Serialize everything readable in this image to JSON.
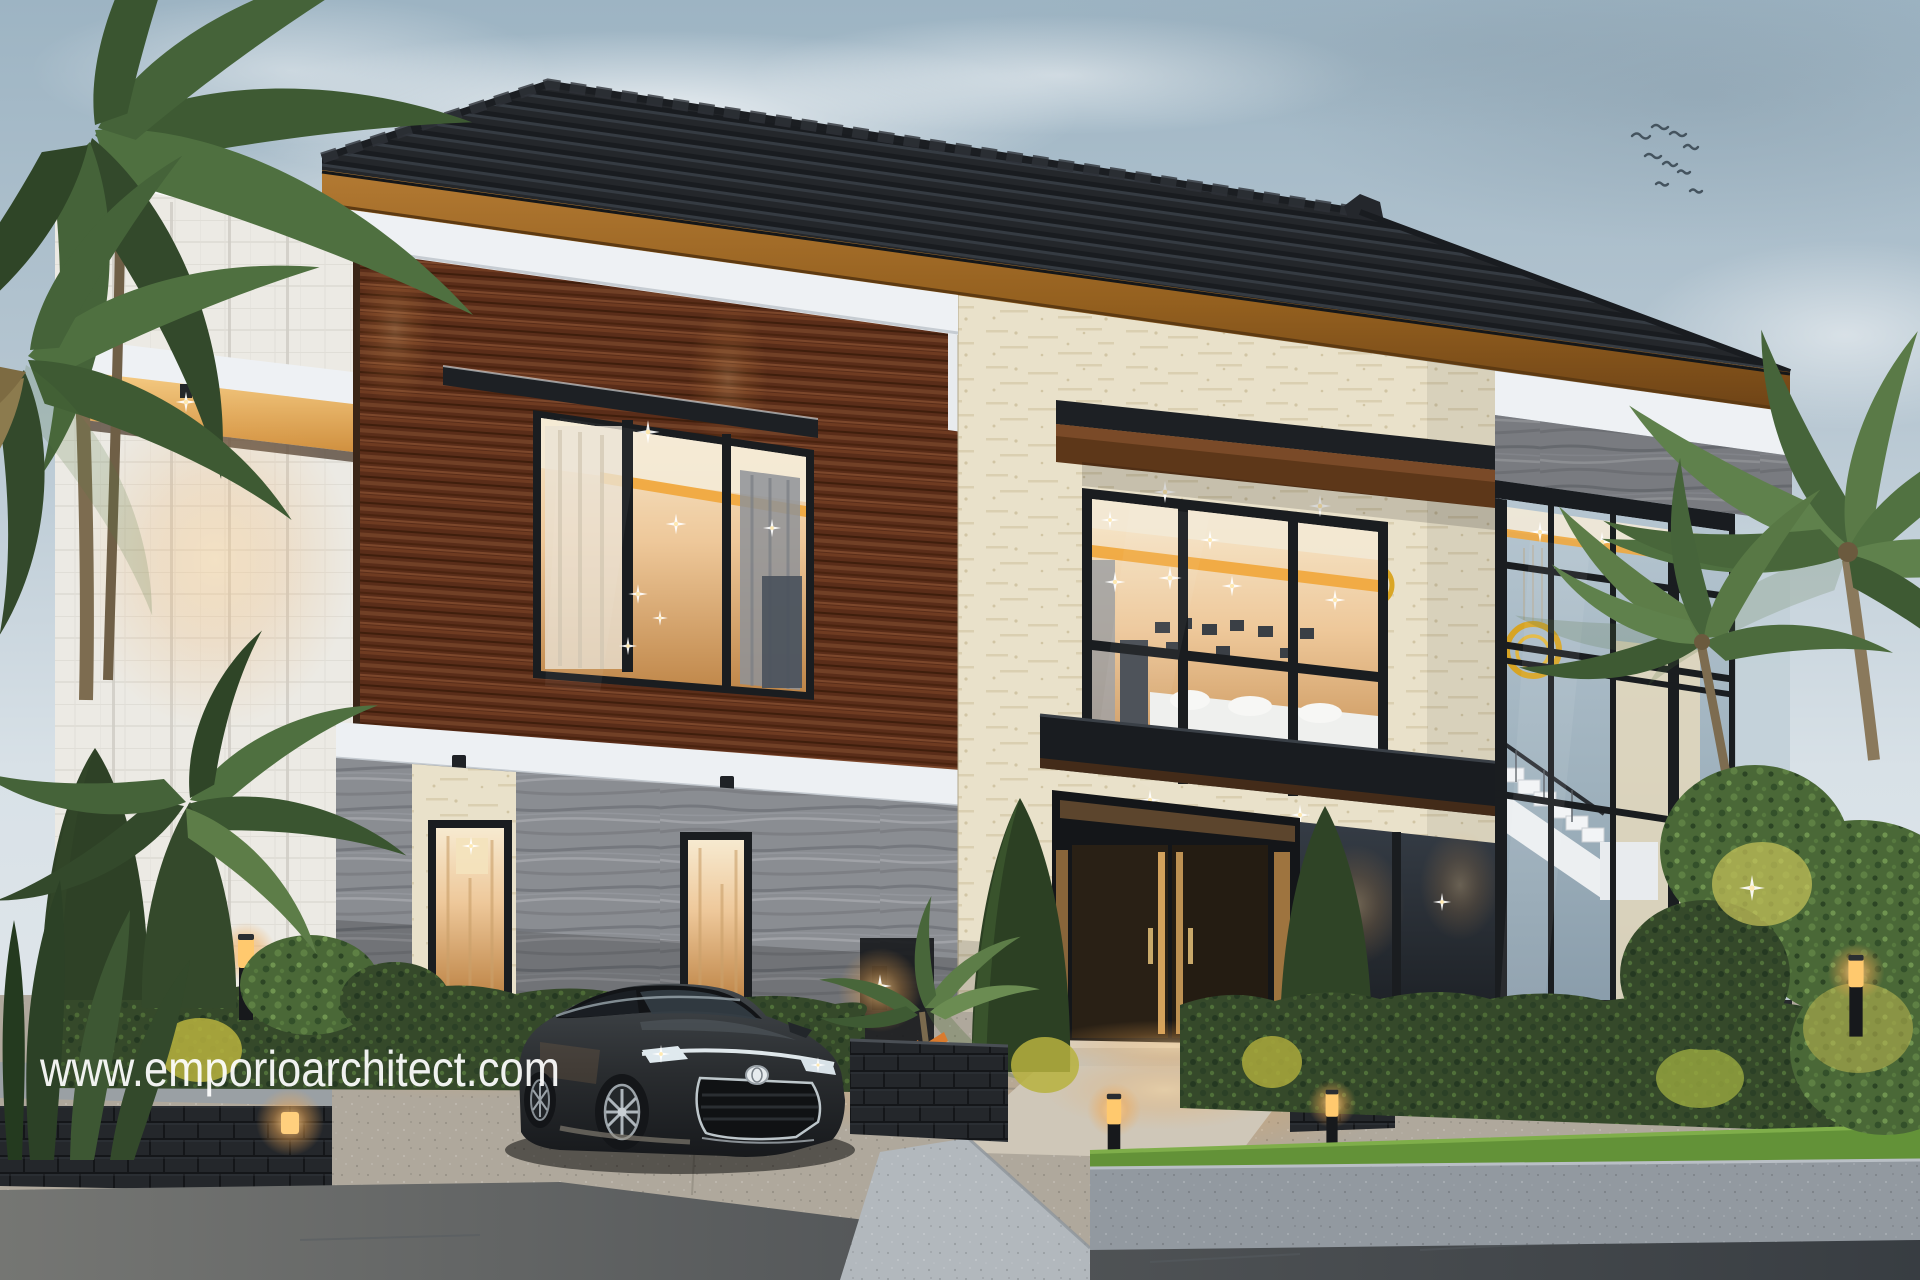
{
  "watermark": {
    "text": "www.emporioarchitect.com",
    "color": "#ffffff"
  },
  "scene": {
    "description": "Dusk 3D exterior rendering of a modern two-storey tropical house: dark ribbed hip roof with timber fascia, walnut wood and cream travertine facades, grey streaked-stone ground floor, black-framed warm-lit windows, glass stair atrium with gold ring chandeliers, manicured hedges, bollard lights, palm trees, and a black Toyota sedan parked on the driveway.",
    "time_of_day": "dusk",
    "objects": [
      "sky",
      "clouds",
      "bird-flock",
      "main-roof",
      "roof-fascia",
      "left-tile-wall",
      "lit-side-canopy",
      "wood-facade",
      "bedroom-window",
      "window-eyebrow-canopy",
      "floor-divider-band",
      "downlights",
      "stone-ground-floor",
      "tall-window-1",
      "tall-window-2",
      "wall-sconce",
      "travertine-facade",
      "living-room-window-box",
      "entrance-canopy",
      "balcony-slab",
      "entrance-doors",
      "door-sidelights",
      "first-floor-glass",
      "stair-atrium-glass",
      "staircase",
      "ring-chandeliers",
      "stone-cap-band",
      "white-fascia-bands",
      "left-palm-cluster",
      "right-palm-cluster",
      "foreground-plants",
      "front-hedge",
      "cone-trees",
      "planters",
      "bollard-lights",
      "lit-shrubs",
      "grass-strip",
      "retaining-wall",
      "driveway-apron",
      "entrance-walkway",
      "ramp",
      "asphalt-road",
      "sedan-car",
      "watermark-text"
    ]
  },
  "palette": {
    "sky-top": "#9db4c3",
    "sky-low": "#e6eaed",
    "cloud": "#ffffff",
    "roof": "#24272b",
    "roof-rib": "#191c20",
    "fascia-wood": "#a06a2c",
    "trim-white": "#eef1f4",
    "wood": "#5a2d19",
    "travertine": "#e9e1ca",
    "stone": "#8a8d92",
    "tile": "#eceae4",
    "frame": "#1a1d20",
    "glass-dark": "#2e333b",
    "glass-sky": "#aebfca",
    "warm-light": "#f2b469",
    "amber-cove": "#f0a93f",
    "hedge": "#35492a",
    "foliage": "#4a6837",
    "grass": "#639238",
    "gold": "#d9a21b",
    "drive": "#afa89c",
    "ramp": "#b2b8bd",
    "road": "#3f4449",
    "plinth": "#24272b",
    "car-body": "#2a2d30",
    "car-chrome": "#e9f1f5"
  }
}
